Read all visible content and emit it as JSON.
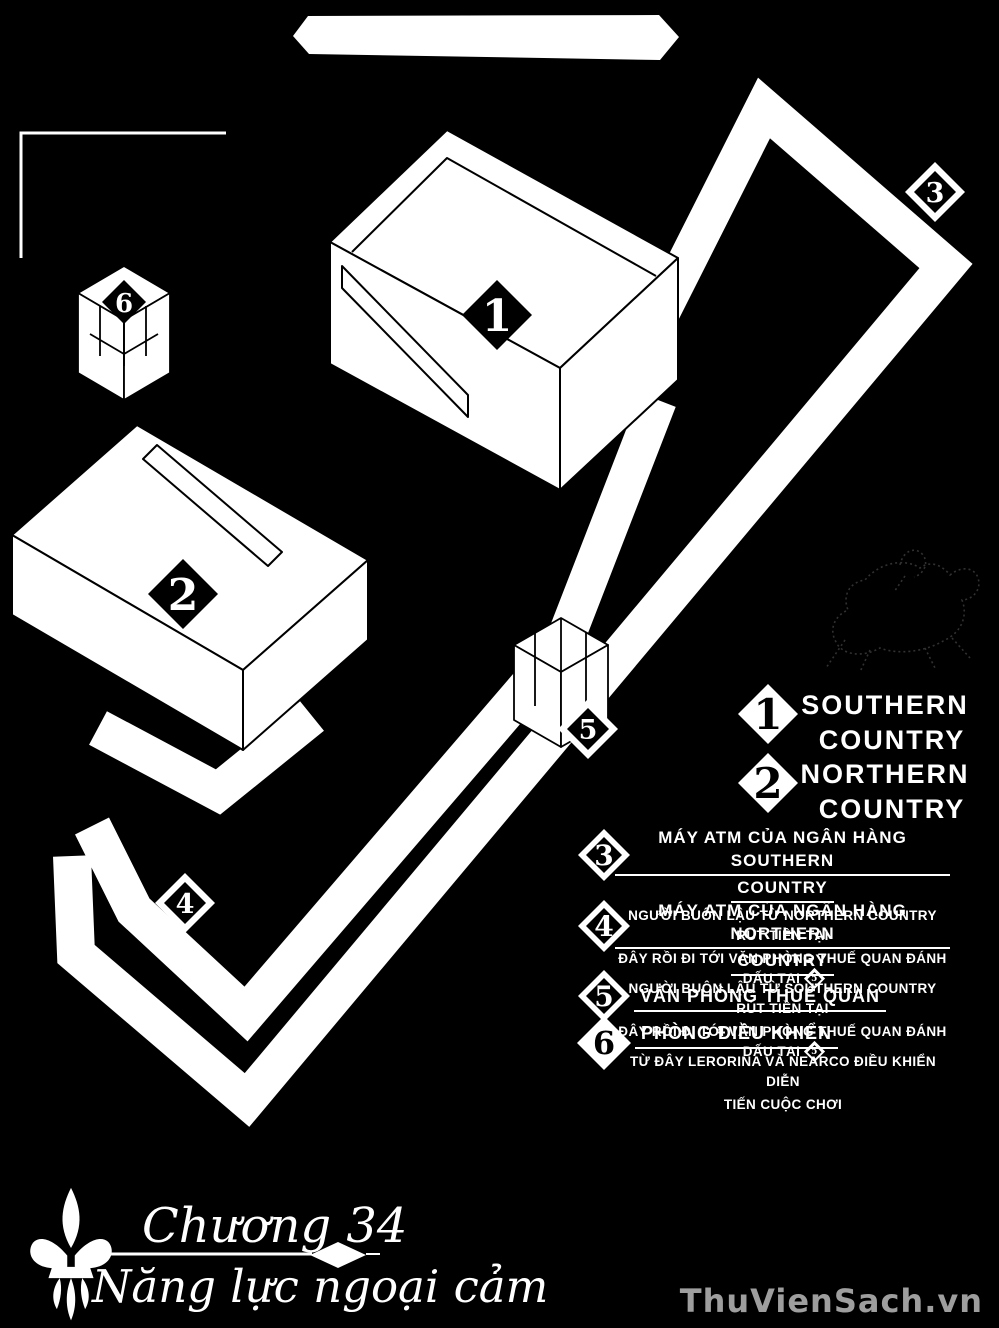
{
  "map": {
    "banner_text": "",
    "marker_labels": {
      "m1": "1",
      "m2": "2",
      "m3": "3",
      "m4": "4",
      "m5": "5",
      "m6": "6"
    }
  },
  "legend": {
    "countries": [
      {
        "num": "1",
        "line1": "SOUTHERN",
        "line2": "COUNTRY"
      },
      {
        "num": "2",
        "line1": "NORTHERN",
        "line2": "COUNTRY"
      }
    ],
    "items": [
      {
        "num": "3",
        "h1": "MÁY ATM CỦA NGÂN HÀNG SOUTHERN",
        "h2": "COUNTRY",
        "b1": "NGƯỜI BUÔN LẬU TỪ NORTHERN COUNTRY RÚT TIỀN TẠI",
        "b2": "ĐÂY RỒI ĐI TỚI VĂN PHÒNG THUẾ QUAN ĐÁNH DẤU TẠI",
        "ref": "5"
      },
      {
        "num": "4",
        "h1": "MÁY ATM CỦA NGÂN HÀNG NORTHERN",
        "h2": "COUNTRY",
        "b1": "NGƯỜI BUÔN LẬU TỪ SOUTHERN COUNTRY RÚT TIỀN TẠI",
        "b2": "ĐÂY RỒI ĐI TỚI VĂN PHÒNG THUẾ QUAN ĐÁNH DẤU TẠI",
        "ref": "5"
      },
      {
        "num": "5",
        "h1": "VĂN PHÒNG THUẾ QUAN "
      },
      {
        "num": "6",
        "h1": "PHÒNG ĐIỀU KHIỂN ",
        "b1": "TỪ ĐÂY LERORINA VÀ NEARCO ĐIỀU KHIỂN DIỄN",
        "b2": "TIẾN CUỘC CHƠI"
      }
    ]
  },
  "footer": {
    "chapter": "Chương 34",
    "title": "Năng lực ngoại cảm"
  },
  "watermark": {
    "text": "ThuVienSach.vn"
  },
  "colors": {
    "background": "#000000",
    "ink": "#ffffff",
    "watermark": "#9e9e9e"
  }
}
